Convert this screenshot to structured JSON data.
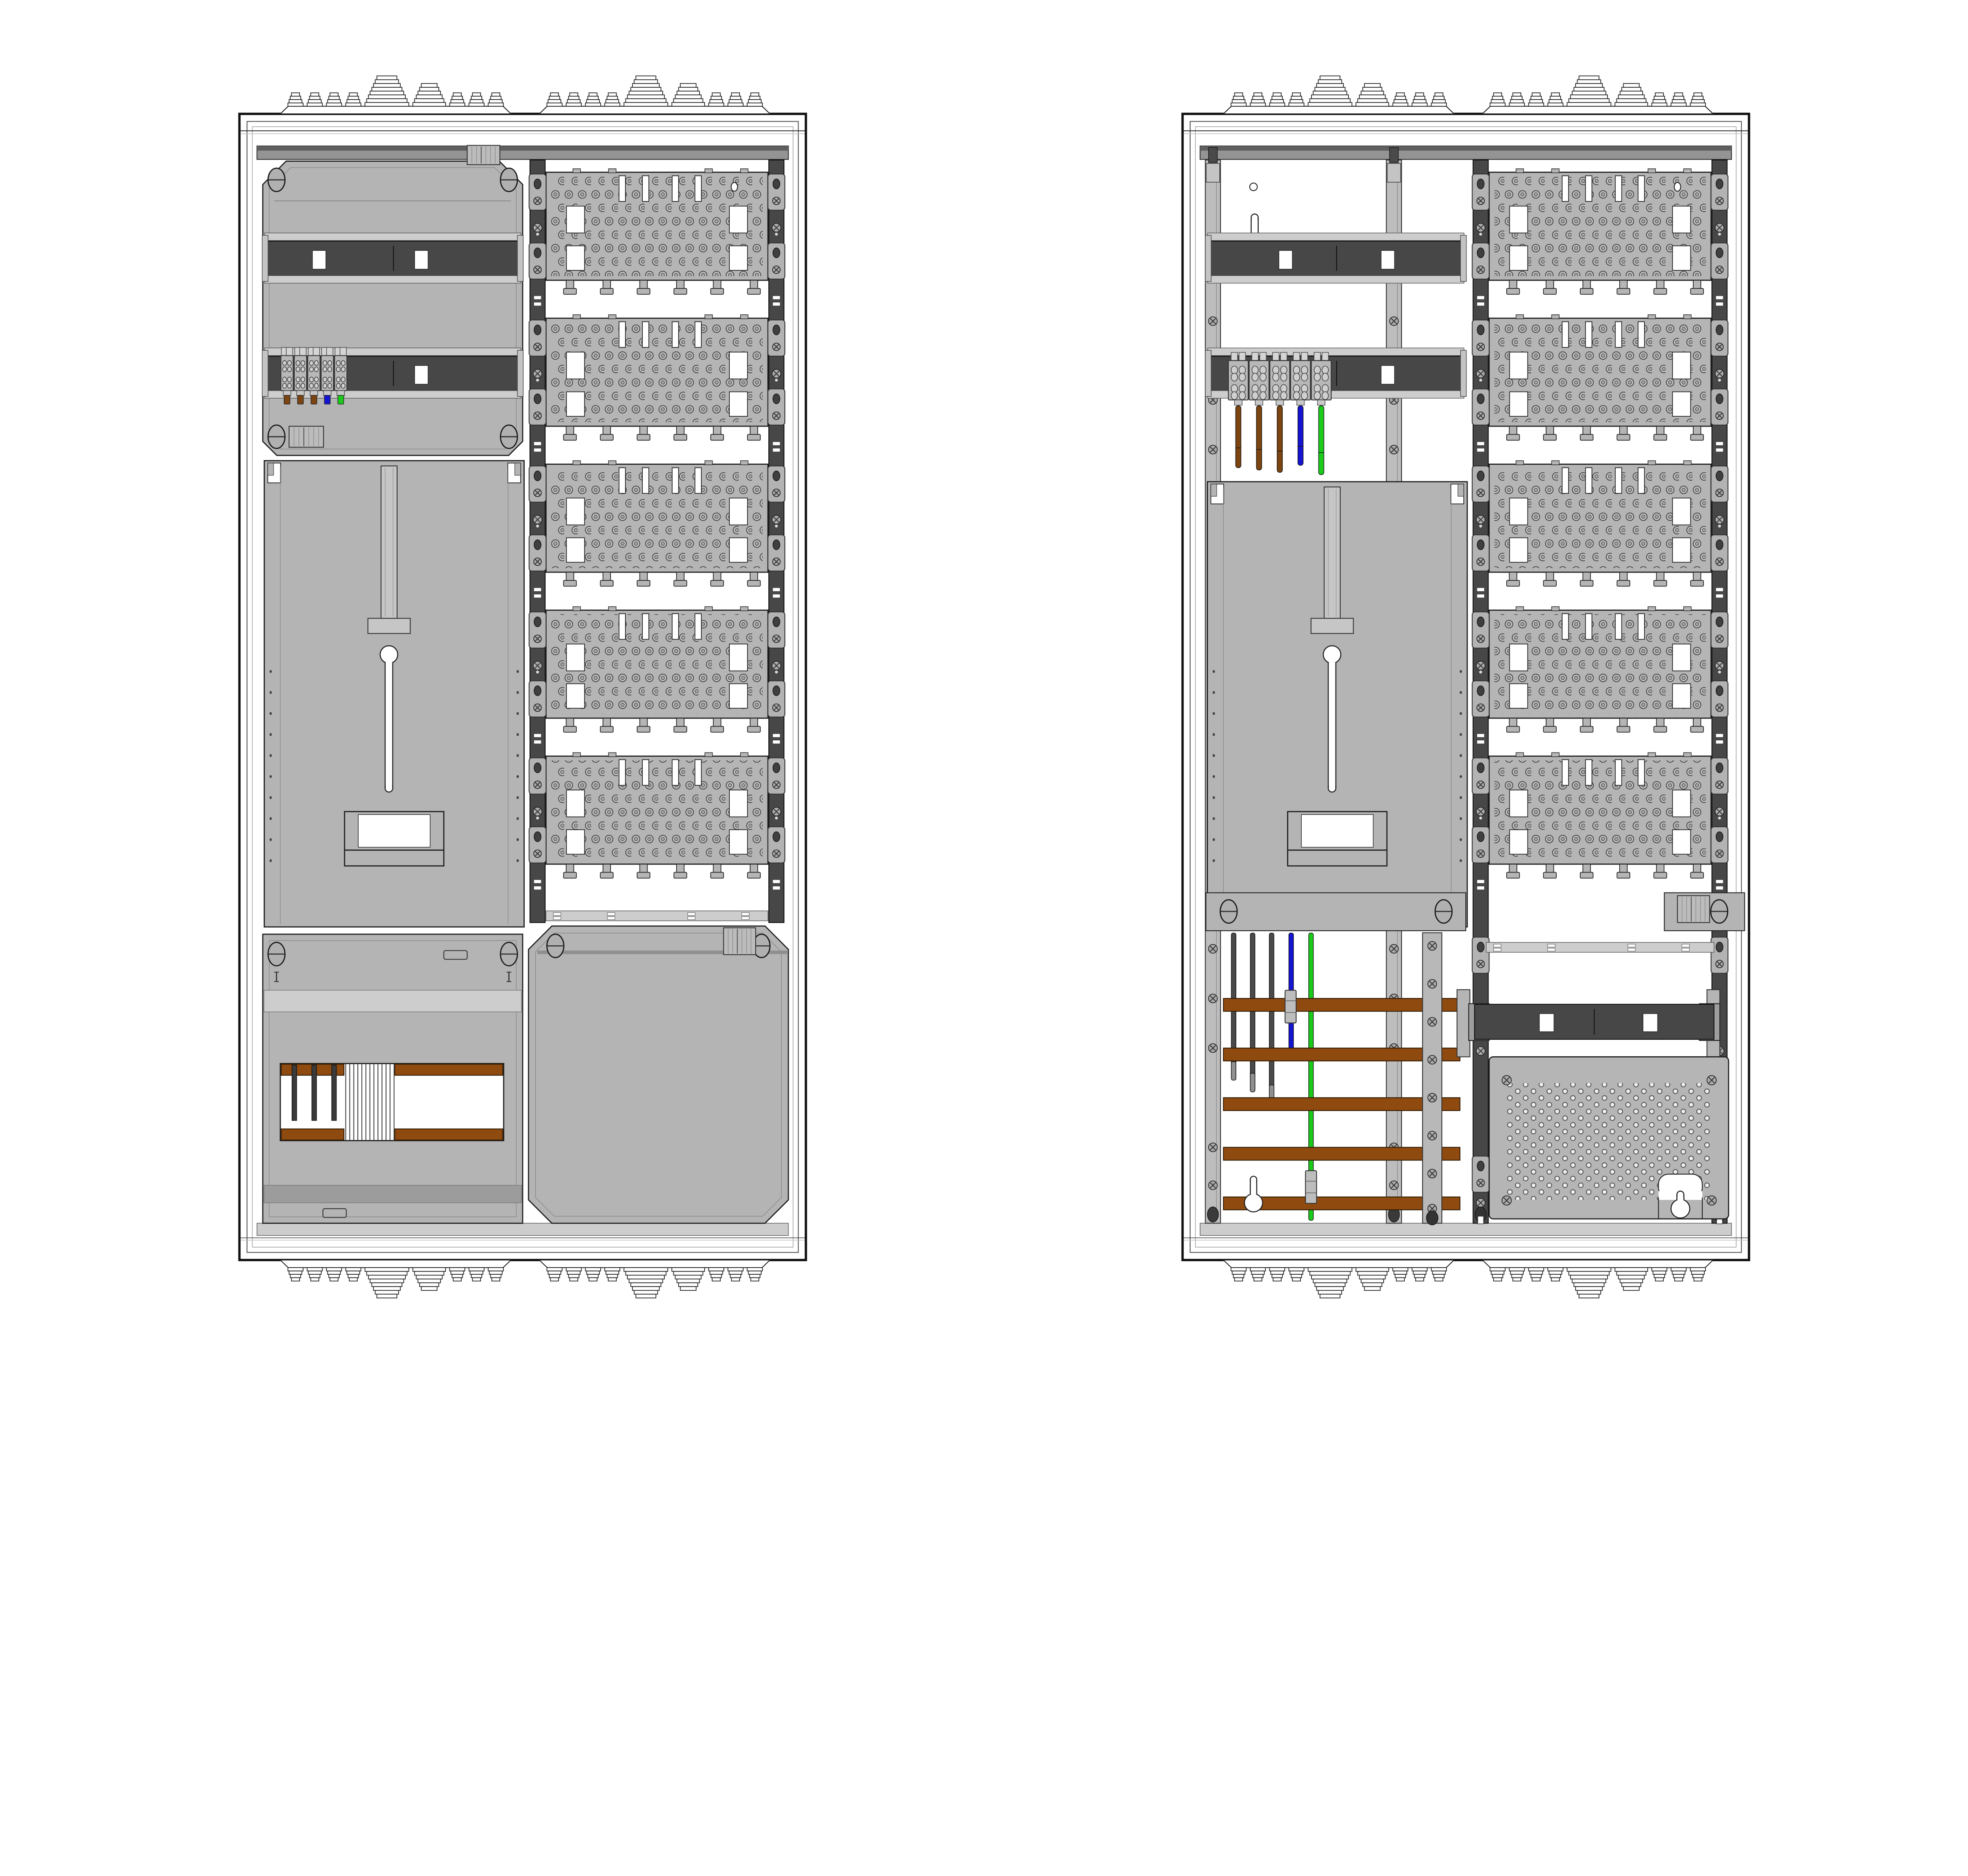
{
  "colors": {
    "background": "#ffffff",
    "outline": "#1a1a1a",
    "panel": "#b4b4b4",
    "panel_light": "#cdcdcd",
    "panel_dark": "#9a9a9a",
    "strip": "#949494",
    "strip_dark": "#5f5f5f",
    "plate": "#b5b5b5",
    "plate_hole": "#c6c6c6",
    "rail_dark": "#474747",
    "clip": "#b3b3b3",
    "screw": "#ababab",
    "busbar_brown": "#8f4a10",
    "wire_brown": "#7c4410",
    "wire_blue": "#1414d2",
    "wire_green": "#1bca1b",
    "wire_black": "#4a4a4a",
    "wire_tip": "#909090",
    "white": "#ffffff"
  },
  "views": [
    {
      "id": "closed",
      "covers": true
    },
    {
      "id": "wired",
      "covers": false
    }
  ],
  "components": {
    "perforated_plates_per_view": 5,
    "plate_top_slots": 4,
    "plate_windows": 4,
    "plate_bottom_tabs": 6,
    "terminal_blocks": 5,
    "terminal_wire_colors": [
      "brown",
      "brown",
      "brown",
      "blue",
      "green"
    ],
    "feeder_wire_colors": [
      "black",
      "black",
      "black",
      "blue",
      "green"
    ],
    "horizontal_busbars": 5,
    "top_din_rails": 2,
    "comb_lines": 13,
    "comb_pins": 3,
    "vent_clusters_per_edge": 2
  }
}
